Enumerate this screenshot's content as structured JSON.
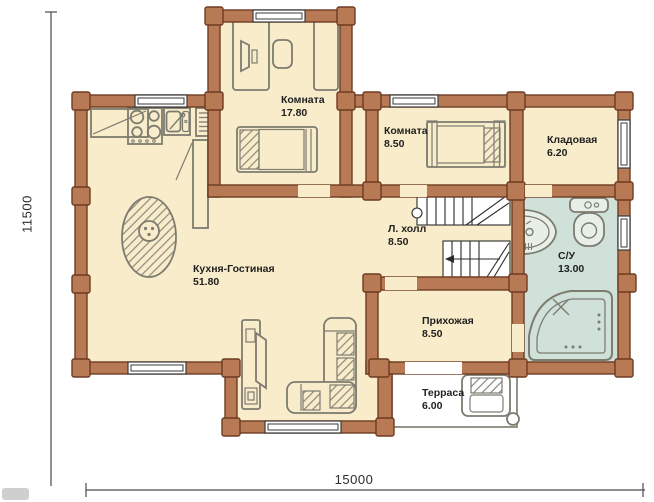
{
  "rooms": [
    {
      "name": "Комната",
      "area": "17.80"
    },
    {
      "name": "Комната",
      "area": "8.50"
    },
    {
      "name": "Кладовая",
      "area": "6.20"
    },
    {
      "name": "Л. холл",
      "area": "8.50"
    },
    {
      "name": "С/У",
      "area": "13.00"
    },
    {
      "name": "Кухня-Гостиная",
      "area": "51.80"
    },
    {
      "name": "Прихожая",
      "area": "8.50"
    },
    {
      "name": "Терраса",
      "area": "6.00"
    }
  ],
  "dimensions": {
    "height_mm": "11500",
    "width_mm": "15000"
  },
  "colors": {
    "wall_fill": "#b87a55",
    "wall_outline": "#6e3b21",
    "floor": "#f9ecca",
    "bathroom_floor": "#cfe1d8",
    "terrace_floor": "#ffffff",
    "furniture_outline": "#7d7c70",
    "stairs_outline": "#2b2b2b",
    "dimension_line": "#4a4a4a"
  }
}
